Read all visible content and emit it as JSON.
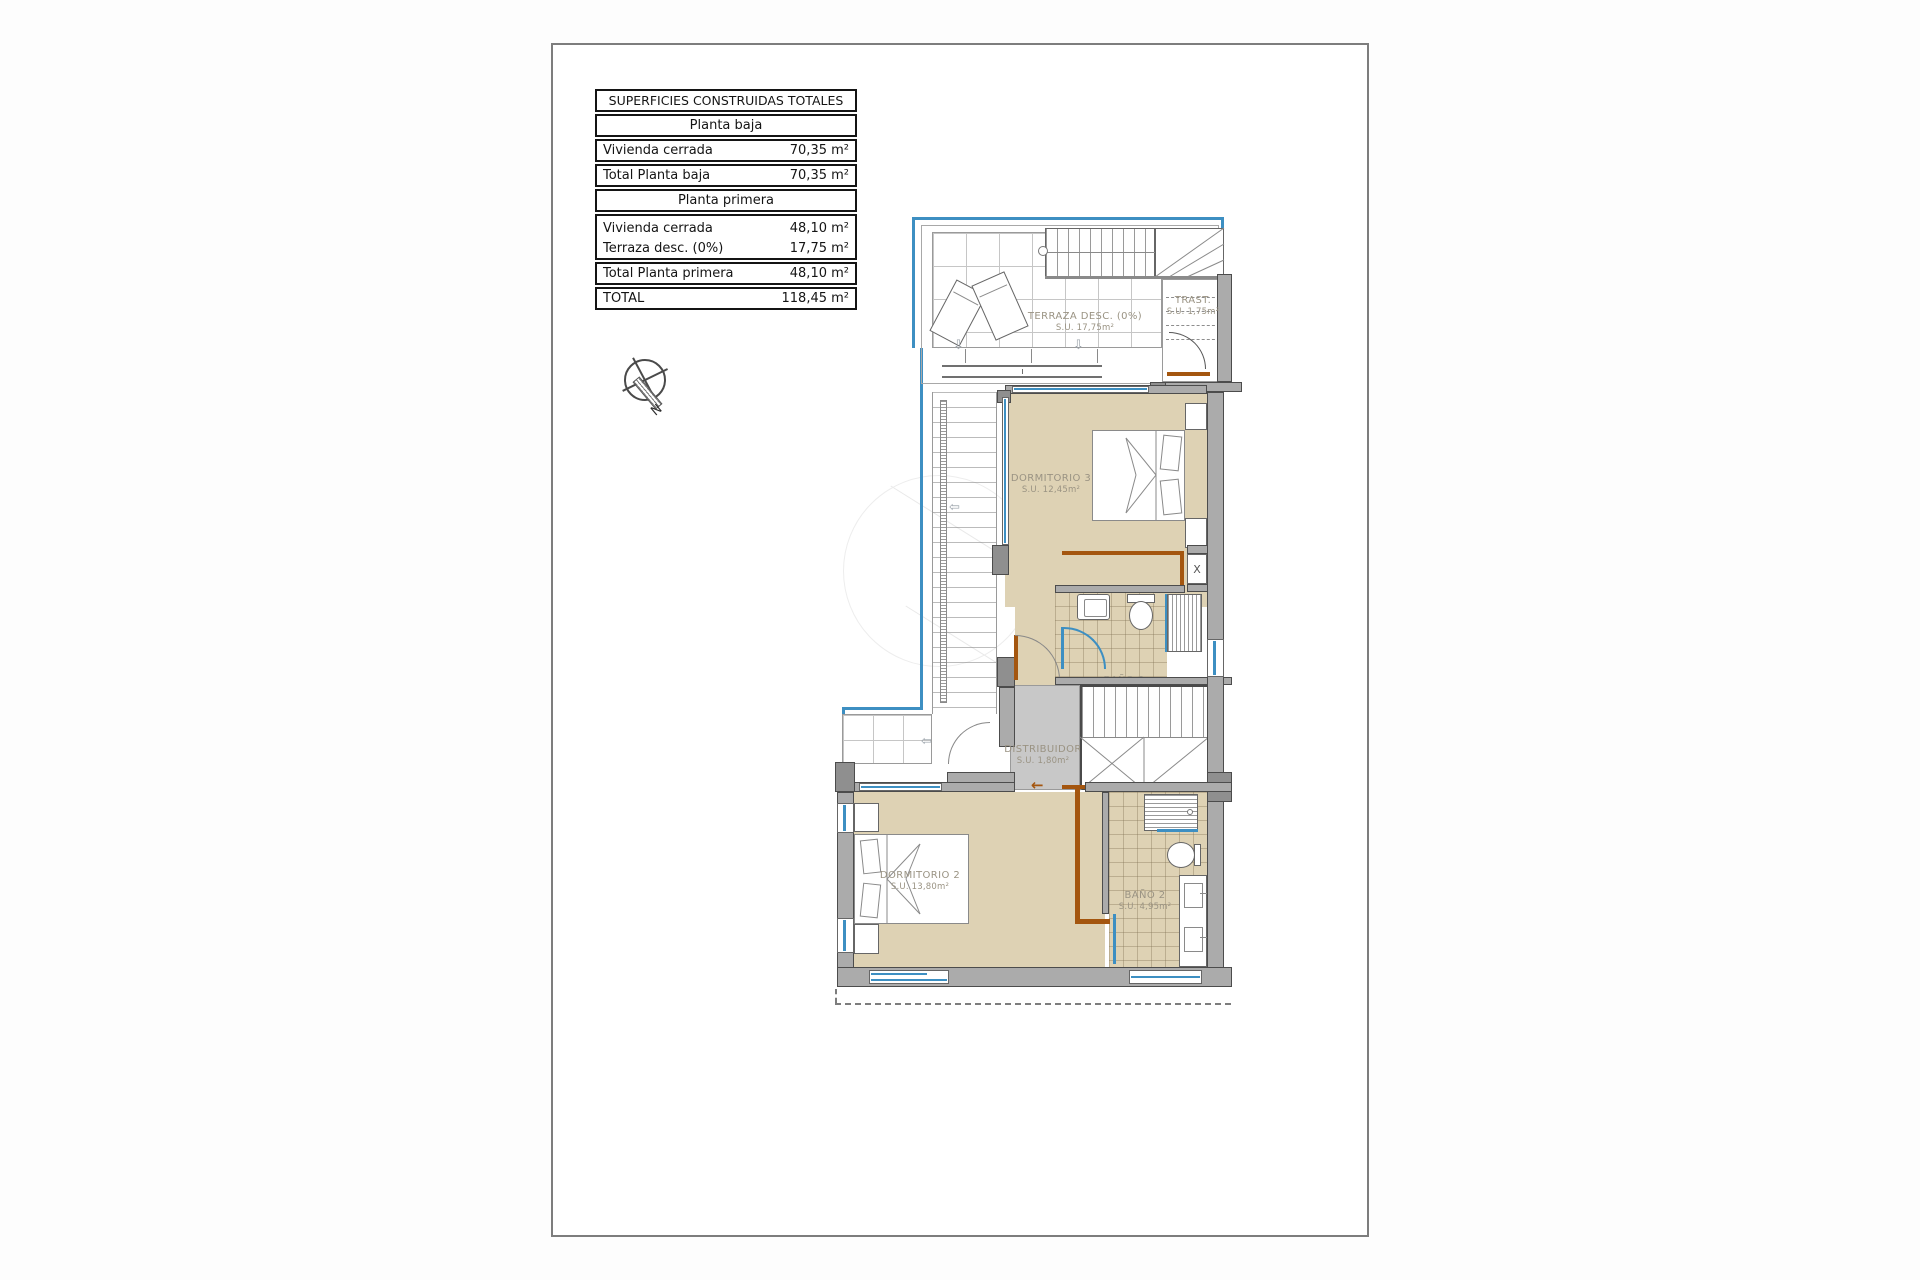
{
  "table": {
    "title": "SUPERFICIES CONSTRUIDAS TOTALES",
    "planta_baja": {
      "header": "Planta baja",
      "rows": [
        {
          "label": "Vivienda cerrada",
          "value": "70,35 m²"
        },
        {
          "label": "Total Planta baja",
          "value": "70,35 m²"
        }
      ]
    },
    "planta_primera": {
      "header": "Planta primera",
      "rows": [
        {
          "label": "Vivienda cerrada",
          "value": "48,10 m²"
        },
        {
          "label": "Terraza desc. (0%)",
          "value": "17,75 m²"
        },
        {
          "label": "Total Planta primera",
          "value": "48,10 m²"
        }
      ]
    },
    "total": {
      "label": "TOTAL",
      "value": "118,45 m²"
    }
  },
  "compass": {
    "north_label": "N"
  },
  "rooms": {
    "terraza": {
      "name": "TERRAZA DESC. (0%)",
      "area": "S.U. 17,75m²"
    },
    "trastero": {
      "name": "TRAST.",
      "area": "S.U. 1,75m²"
    },
    "dormitorio3": {
      "name": "DORMITORIO 3",
      "area": "S.U. 12,45m²"
    },
    "bano3": {
      "name": "BAÑO 3",
      "area": "S.U. 3,75m²"
    },
    "distribuidor": {
      "name": "DISTRIBUIDOR",
      "area": "S.U. 1,80m²"
    },
    "dormitorio2": {
      "name": "DORMITORIO 2",
      "area": "S.U. 13,80m²"
    },
    "bano2": {
      "name": "BAÑO 2",
      "area": "S.U. 4,95m²"
    }
  },
  "annotations": {
    "shaft_label": "X"
  },
  "colors": {
    "glazing_blue": "#3d8fc2",
    "wall_gray": "#ababab",
    "floor_tan": "#ded2b4",
    "carpentry_brown": "#a4560f",
    "hall_gray": "#c8c8c8"
  }
}
